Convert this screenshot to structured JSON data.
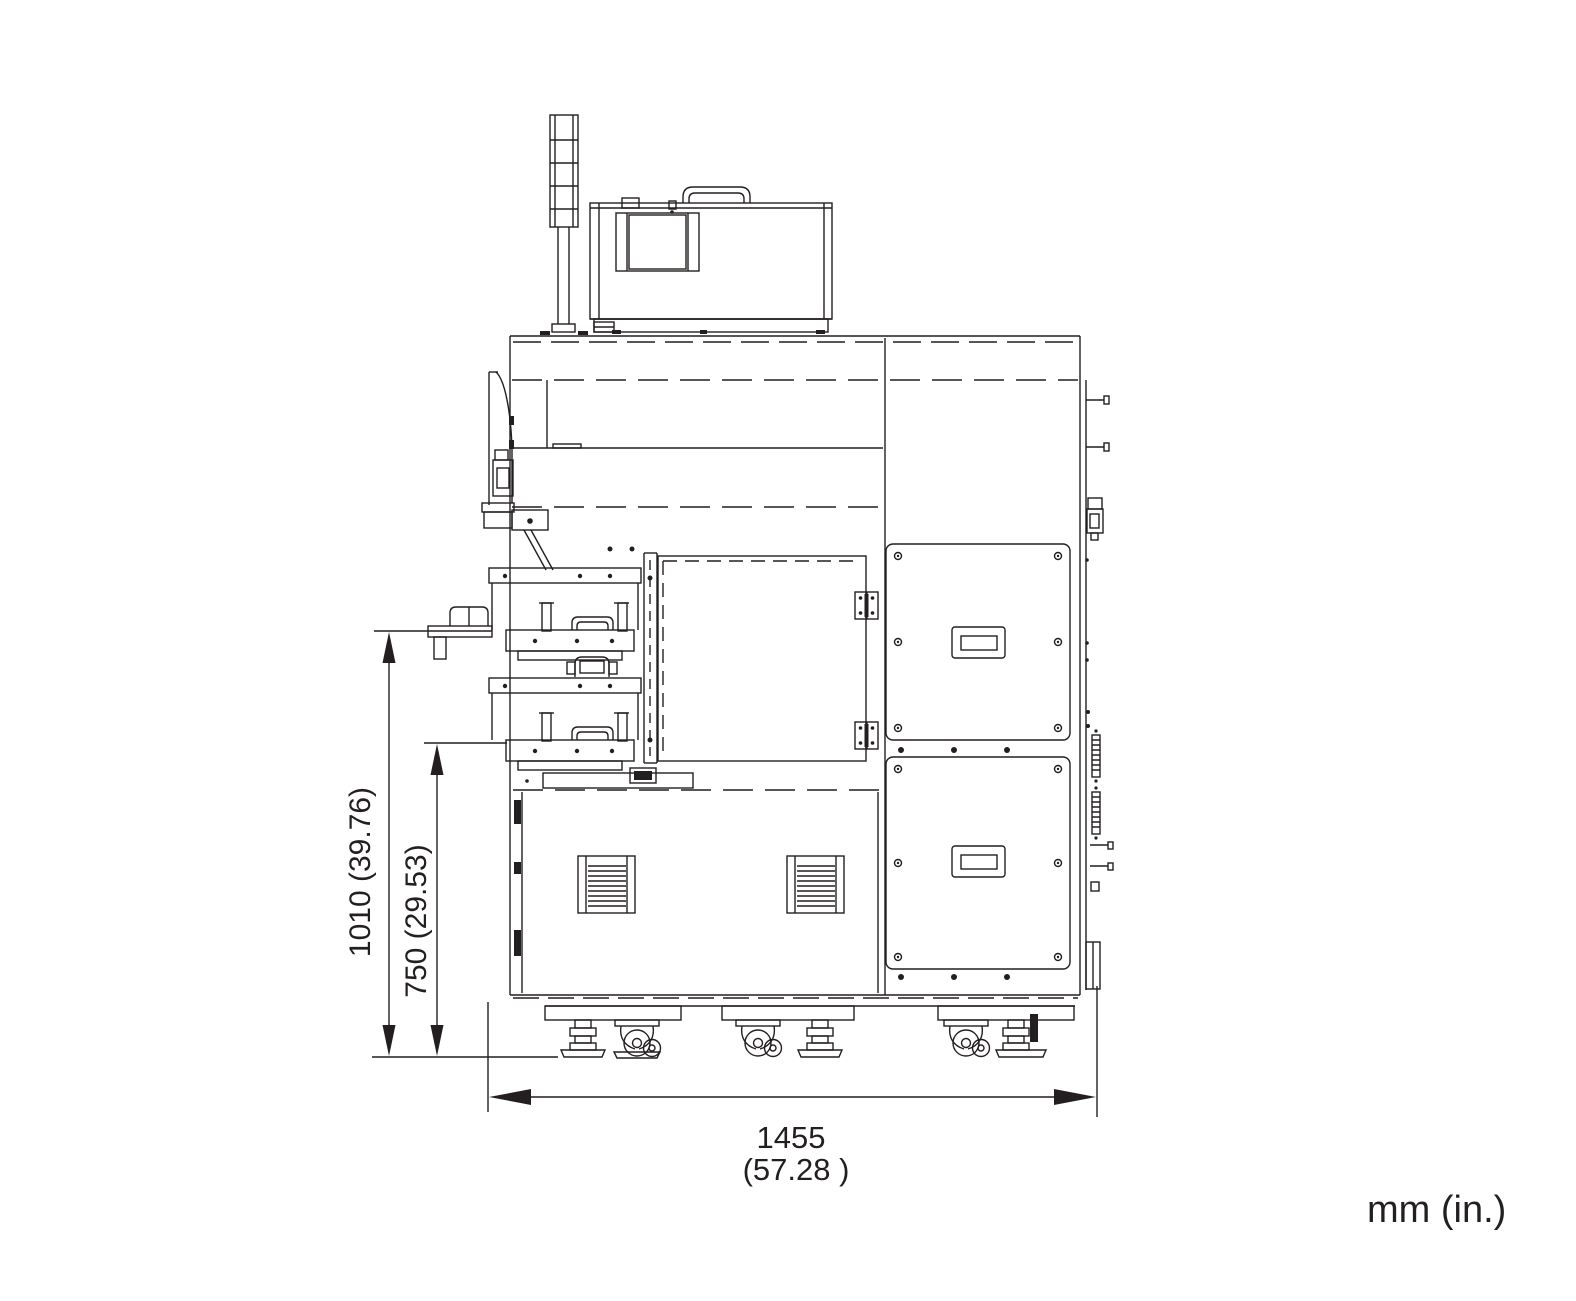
{
  "drawing": {
    "type": "technical-dimension-drawing",
    "view": "machine-front-elevation",
    "units_note": "mm (in.)",
    "dim_height_overall": "1010 (39.76)",
    "dim_height_tray": "750 (29.53)",
    "dim_width_value": "1455",
    "dim_width_inches": "(57.28 )"
  },
  "colors": {
    "line": "#231f20",
    "background": "#ffffff"
  }
}
